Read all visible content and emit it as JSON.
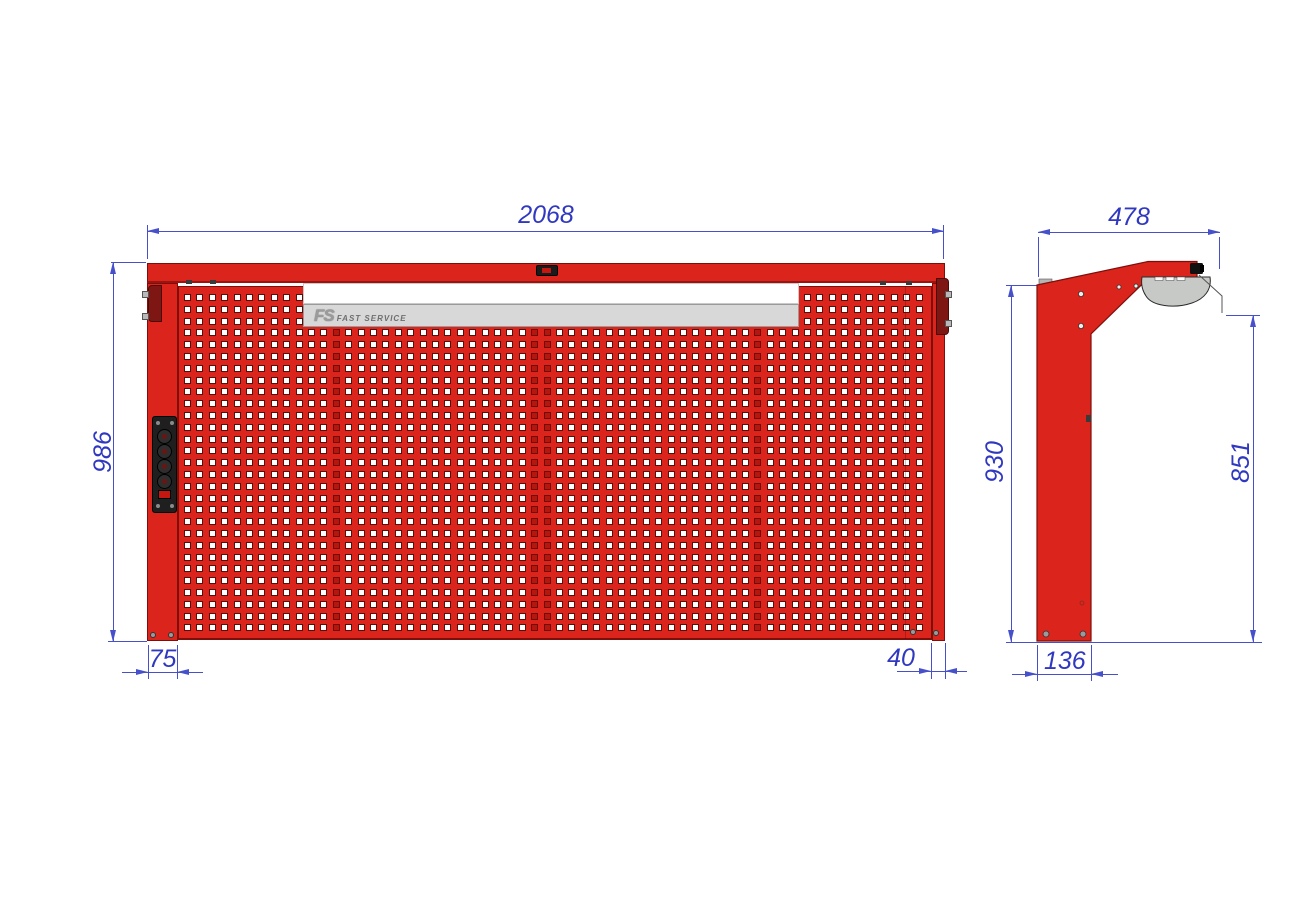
{
  "drawing": {
    "type": "2D dimensioned technical drawing",
    "subject": "red perforated tool panel with lamp arm, front and side views"
  },
  "logo": {
    "abbr": "FS",
    "name": "FAST SERVICE"
  },
  "front_view": {
    "dims": {
      "width": "2068",
      "height": "986",
      "offset_left": "75",
      "offset_right": "40"
    }
  },
  "side_view": {
    "dims": {
      "depth": "478",
      "height": "930",
      "lamp_height": "851",
      "base": "136"
    }
  },
  "colors": {
    "panel_red": "#da241c",
    "panel_dark_red": "#7d0f0b",
    "bracket_maroon": "#7e1713",
    "dimension_blue": "#3038c0",
    "logo_band_gray": "#d8d8d8",
    "lamp_gray": "#c6c9c5"
  }
}
